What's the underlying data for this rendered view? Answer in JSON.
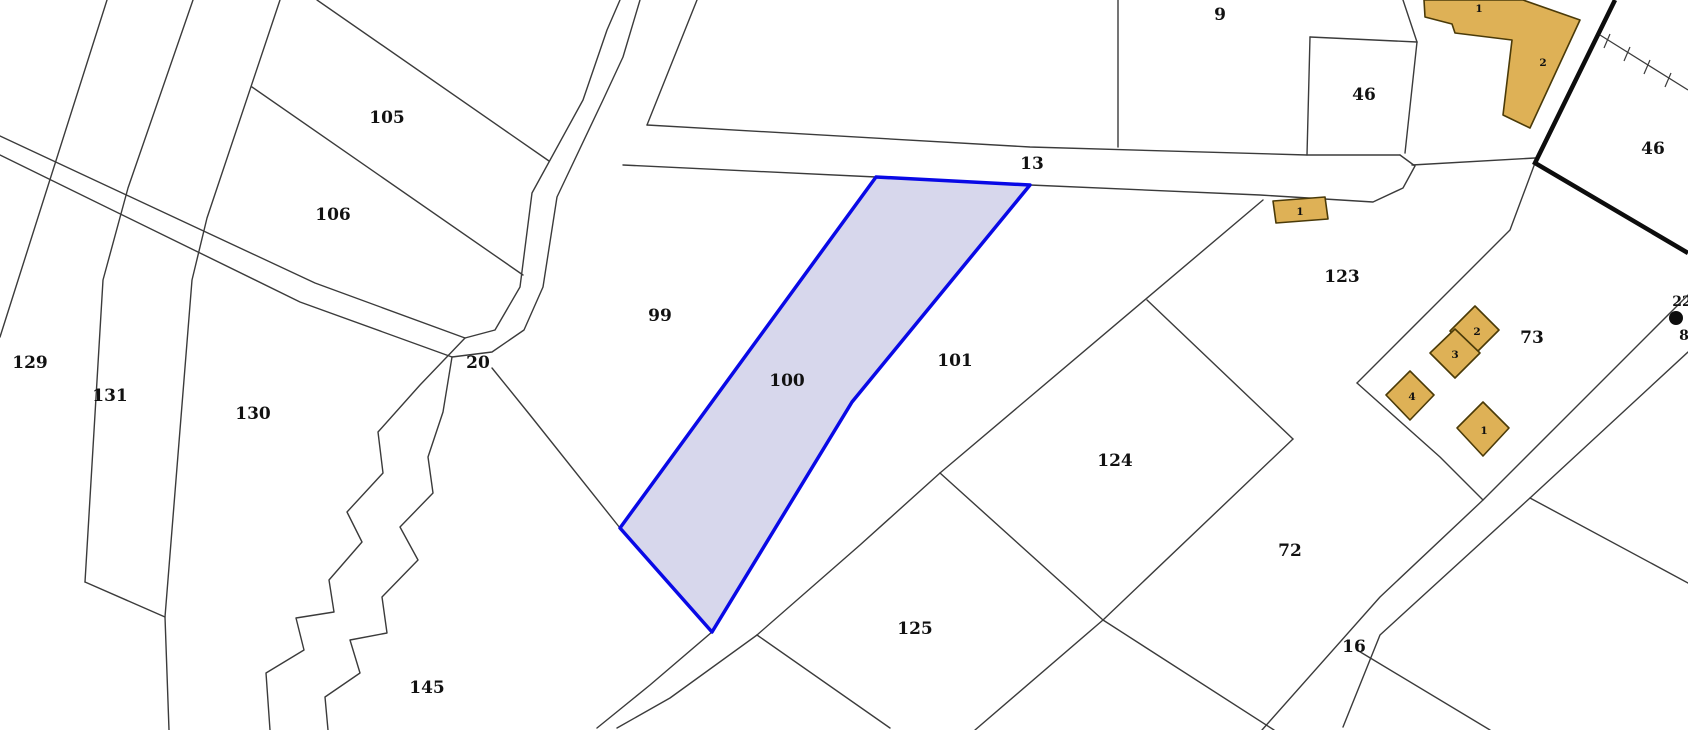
{
  "map": {
    "type": "cadastral-parcel-map",
    "background_color": "#ffffff",
    "boundary_line_color": "#3b3b3b",
    "selected_parcel": {
      "id": "100",
      "fill_color": "#d7d7ec",
      "stroke_color": "#0909e6"
    },
    "building_fill_color": "#deb156",
    "building_stroke_color": "#4a3a08",
    "municipal_boundary_color": "#0d0d0d",
    "parcel_labels": [
      {
        "text": "105"
      },
      {
        "text": "106"
      },
      {
        "text": "129"
      },
      {
        "text": "131"
      },
      {
        "text": "130"
      },
      {
        "text": "20"
      },
      {
        "text": "145"
      },
      {
        "text": "99"
      },
      {
        "text": "100"
      },
      {
        "text": "101"
      },
      {
        "text": "13"
      },
      {
        "text": "9"
      },
      {
        "text": "46"
      },
      {
        "text": "123"
      },
      {
        "text": "124"
      },
      {
        "text": "125"
      },
      {
        "text": "72"
      },
      {
        "text": "73"
      },
      {
        "text": "16"
      },
      {
        "text": "46"
      }
    ],
    "building_labels": [
      {
        "text": "1"
      },
      {
        "text": "2"
      },
      {
        "text": "1"
      },
      {
        "text": "2"
      },
      {
        "text": "3"
      },
      {
        "text": "4"
      },
      {
        "text": "1"
      }
    ],
    "edge_labels": [
      {
        "text": "22"
      },
      {
        "text": "8"
      }
    ],
    "icons": [
      {
        "name": "survey-point-icon"
      }
    ]
  }
}
